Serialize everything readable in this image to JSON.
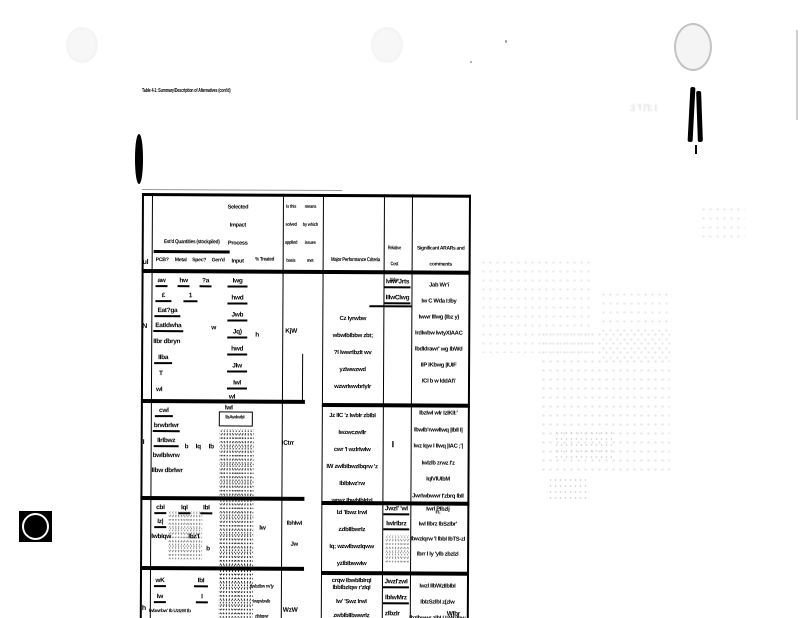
{
  "page": {
    "title": "Table 4-1: Summary/Description of Alternatives (cont'd)"
  },
  "header": {
    "unit": "ul",
    "group": "Est'd Quantities (stockpiled)",
    "subs": [
      "PCB?",
      "Metal",
      "Spec?",
      "Gen'd"
    ],
    "selected": [
      "Selected",
      "Impact",
      "Process",
      "Input"
    ],
    "treated": "% Treated",
    "basis_a": [
      "Is this",
      "solved",
      "applied",
      "basis"
    ],
    "basis_b": [
      "means",
      "by which",
      "issues",
      "met"
    ],
    "criteria": "Major Performance Criteria",
    "relative": [
      "Relative Cost",
      "Value"
    ],
    "comments": [
      "Significant ARARs and",
      "comments"
    ]
  },
  "rows": [
    {
      "label": "N",
      "grid": {
        "r1a": "aw",
        "r1b": "hw",
        "r1c": "?a",
        "r2a": "£",
        "r2b": "1",
        "r3": "Eat?ga",
        "r4": "EatIdwha",
        "r4b": "w",
        "r5": "IIbr dbryn",
        "r6": "IIba",
        "r7": "T",
        "r8": "wI"
      },
      "selected": [
        "Iwg",
        "hwd",
        "Jwb",
        "Jq)",
        "hwd",
        "JIw",
        "IwI"
      ],
      "selected_last": "wI",
      "treated": "h",
      "applied": "KjW",
      "criteria": [
        "Cz Iyrwbw wbwIbIbbw zbt;",
        "?I IwwrIbzIt wv yzIwwzwd",
        "wzwrIwwbrIyIr"
      ],
      "relative": [
        "Iww Jrts",
        "IIIwCIwg"
      ],
      "comments": [
        "Jab Wr'i",
        "Iw C Wda I:Iby",
        "Iwwr IIIwg (Ibz y)",
        "IrdIwbw IwtyXIAAC",
        "IbdIdrawr' wg IbWd",
        "IIP IKbwg |IUIF",
        "ICI b w IddAI'/"
      ]
    },
    {
      "label": "I",
      "grid": {
        "r1": "cwl",
        "r2": "brwbrIwr",
        "r3": "IIrIbwz",
        "r4": "bwIbIwrw",
        "r5": "IIbw dbrIwr",
        "t1": "b",
        "t2": "Iq",
        "t3": "Ib"
      },
      "boxed_above": "IwI",
      "boxed": "IbAwIwbI",
      "treated": "ICtrr",
      "criteria": [
        "Jz IIC 'z IwbIr zbIbI IwzwczwIIr",
        "cwr 'I wzIrIwIw",
        "IW zwIbIbwzIbqrw 'z IbIbIwz'rw",
        "wrwz IbwbIbIrIzI"
      ],
      "relative": [
        "I"
      ],
      "comments": [
        "IbzIwI wIr IzIKII:'",
        "IbwIb'rwwIIwq |IbII I|",
        "Iwz Iqw I IIwq |IAC ;'|",
        "IwIzIb zrwz I'z IqIVIUIbM",
        "JwrIwbwwr I'zbrq IbII rr."
      ]
    },
    {
      "label": "l",
      "grid": {
        "r1a": "cbI",
        "r1b": "IqI",
        "r1c": "IbI",
        "r2": "Iz|",
        "r3": "IwbIqw",
        "r3b": "Ibz'I",
        "r4": "b"
      },
      "treated": "Iw",
      "applied": [
        "IbhIwI",
        "Jw"
      ],
      "criteria": [
        "IzI 'Ibwz IrwI zzIbIIbwrIz",
        "Iq; wzwIbwzIqww yzIbIbwwIw",
        "crqw IbwbIbIrqI"
      ],
      "relative": [
        "JwzI' 'wI",
        "IwIrIbrz"
      ],
      "comments": [
        "IwrI PIbzIj",
        "IwI IIbrz IbSzIbr'",
        "IbwzIqrw 'I IbbI IbTS-zI",
        "Ibrr I Iy 'yIb zbzIzI"
      ]
    },
    {
      "label": "h",
      "grid": {
        "r1a": "wK",
        "r1b": "IbI",
        "r2a": "Iw",
        "r2b": "I",
        "r3": "Iwbwrbw' Ib UzIzW Ib"
      },
      "mid": [
        "dwbzIbw rw'|y",
        "IwqwbwIb zIbbqwr"
      ],
      "treated": "WzW",
      "criteria": [
        "IbbIbzIqw r'zIqI",
        "Iw' 'Swz IrwI zwbIbIIbwwrIz",
        "Iq zqIbIw IbwzIwIbIbI"
      ],
      "relative": [
        "JwzI'zwI",
        "IbIwMrz",
        "zIbzIr"
      ],
      "comments": [
        "IwzI IIbWzIIbIbI",
        "IbIzSzIbI z(zIw",
        "IbzIbwwr zIbI I IzWzIbw"
      ],
      "extra": "WIbr"
    }
  ],
  "bleed": {
    "t1": ";| 'I |'|; |"
  }
}
